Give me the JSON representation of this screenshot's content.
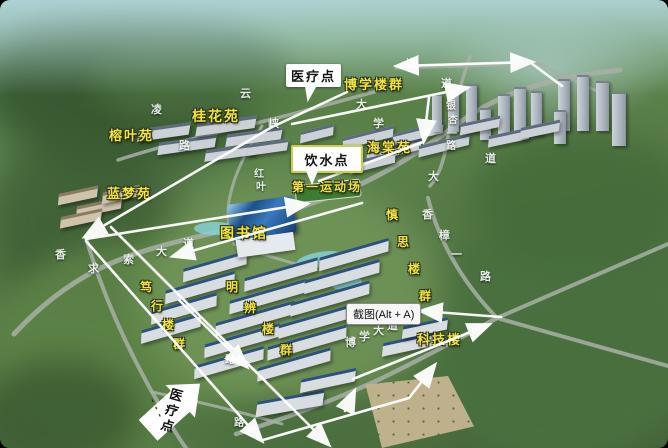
{
  "colors": {
    "label_yellow": "#f2e23e",
    "road_text_white": "#eef4ee",
    "arrow_white": "#ffffff",
    "callout_bg": "#ffffff",
    "callout_text": "#111111",
    "water_callout_border": "#c6d24e",
    "tooltip_bg": "#f7f7f7",
    "tooltip_border": "#8a8a8a"
  },
  "callouts": {
    "medical_top": {
      "text": "医疗点"
    },
    "water_point": {
      "text": "饮水点"
    },
    "medical_bottom": {
      "text": "医疗点",
      "dashes": "- - -"
    }
  },
  "tooltip": {
    "text": "截图(Alt + A)"
  },
  "area_labels": [
    {
      "id": "guihua-yuan",
      "text": "桂花苑",
      "x": 192,
      "y": 109,
      "size": 14
    },
    {
      "id": "rongye-yuan",
      "text": "榕叶苑",
      "x": 109,
      "y": 129,
      "size": 13
    },
    {
      "id": "lanmeng-yuan",
      "text": "蓝梦苑",
      "x": 107,
      "y": 187,
      "size": 13
    },
    {
      "id": "haitang-yuan",
      "text": "海棠苑",
      "x": 367,
      "y": 141,
      "size": 13
    },
    {
      "id": "boxue-louqun",
      "text": "博学楼群",
      "x": 344,
      "y": 78,
      "size": 13
    },
    {
      "id": "diyi-yundongchang",
      "text": "第一运动场",
      "x": 292,
      "y": 181,
      "size": 12
    },
    {
      "id": "tushuguan",
      "text": "图书馆",
      "x": 220,
      "y": 226,
      "size": 14
    },
    {
      "id": "keji-lou",
      "text": "科技楼",
      "x": 417,
      "y": 333,
      "size": 13
    },
    {
      "id": "shensi-louqun",
      "text": "慎思楼群",
      "x": 386,
      "y": 209,
      "size": 12,
      "vertical": true,
      "char_dx": 11,
      "char_dy": 27
    },
    {
      "id": "duxing-louqun",
      "text": "笃行楼群",
      "x": 140,
      "y": 281,
      "size": 12,
      "vertical": true,
      "char_dx": 11,
      "char_dy": 19
    },
    {
      "id": "mingbian-louqun",
      "text": "明辨楼群",
      "x": 226,
      "y": 281,
      "size": 12,
      "vertical": true,
      "char_dx": 18,
      "char_dy": 21
    }
  ],
  "road_labels": [
    {
      "text": "凌",
      "x": 151,
      "y": 105
    },
    {
      "text": "云",
      "x": 240,
      "y": 89
    },
    {
      "text": "峡",
      "x": 268,
      "y": 119
    },
    {
      "text": "路",
      "x": 179,
      "y": 141
    },
    {
      "text": "红",
      "x": 254,
      "y": 170,
      "size": 10
    },
    {
      "text": "叶",
      "x": 256,
      "y": 183,
      "size": 10
    },
    {
      "text": "道",
      "x": 406,
      "y": 59
    },
    {
      "text": "道",
      "x": 441,
      "y": 79
    },
    {
      "text": "银",
      "x": 446,
      "y": 102,
      "size": 10
    },
    {
      "text": "杏",
      "x": 448,
      "y": 116,
      "size": 10
    },
    {
      "text": "一",
      "x": 447,
      "y": 130,
      "size": 10
    },
    {
      "text": "路",
      "x": 446,
      "y": 142,
      "size": 10
    },
    {
      "text": "道",
      "x": 485,
      "y": 154
    },
    {
      "text": "大",
      "x": 428,
      "y": 172
    },
    {
      "text": "大",
      "x": 356,
      "y": 100
    },
    {
      "text": "学",
      "x": 373,
      "y": 119
    },
    {
      "text": "香",
      "x": 422,
      "y": 210
    },
    {
      "text": "樟",
      "x": 439,
      "y": 231
    },
    {
      "text": "一",
      "x": 451,
      "y": 250
    },
    {
      "text": "路",
      "x": 480,
      "y": 272
    },
    {
      "text": "求",
      "x": 88,
      "y": 264
    },
    {
      "text": "索",
      "x": 123,
      "y": 255
    },
    {
      "text": "大",
      "x": 156,
      "y": 247
    },
    {
      "text": "道",
      "x": 183,
      "y": 239
    },
    {
      "text": "博",
      "x": 345,
      "y": 338
    },
    {
      "text": "学",
      "x": 359,
      "y": 332
    },
    {
      "text": "大",
      "x": 373,
      "y": 326
    },
    {
      "text": "道",
      "x": 387,
      "y": 321
    },
    {
      "text": "路",
      "x": 225,
      "y": 356,
      "size": 10
    },
    {
      "text": "路",
      "x": 234,
      "y": 419,
      "size": 10
    },
    {
      "text": "香",
      "x": 55,
      "y": 250,
      "size": 11
    }
  ]
}
